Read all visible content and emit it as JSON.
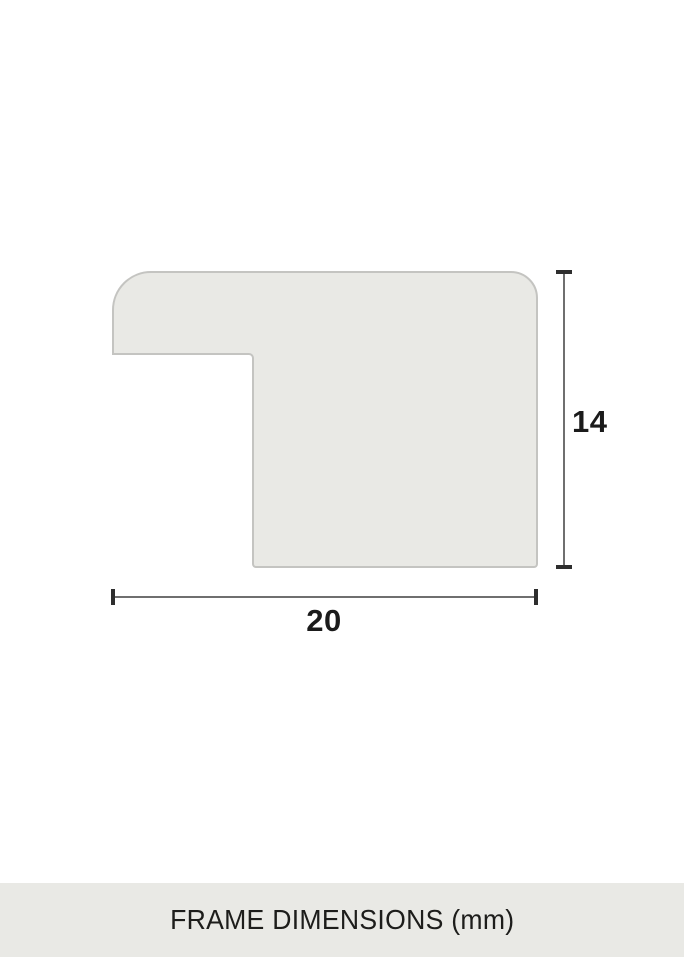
{
  "diagram": {
    "type": "frame-profile-cross-section",
    "height_label": "14",
    "width_label": "20",
    "units": "mm"
  },
  "caption": {
    "text": "FRAME DIMENSIONS (mm)"
  },
  "colors": {
    "page_background": "#ffffff",
    "shape_fill": "#e9e9e5",
    "shape_border": "#c4c4c1",
    "dimension_line": "#6f6f6f",
    "dimension_cap": "#2e2e2e",
    "label_text": "#1b1b1b",
    "caption_background": "#e9e9e5",
    "caption_text": "#1d1d1b"
  }
}
